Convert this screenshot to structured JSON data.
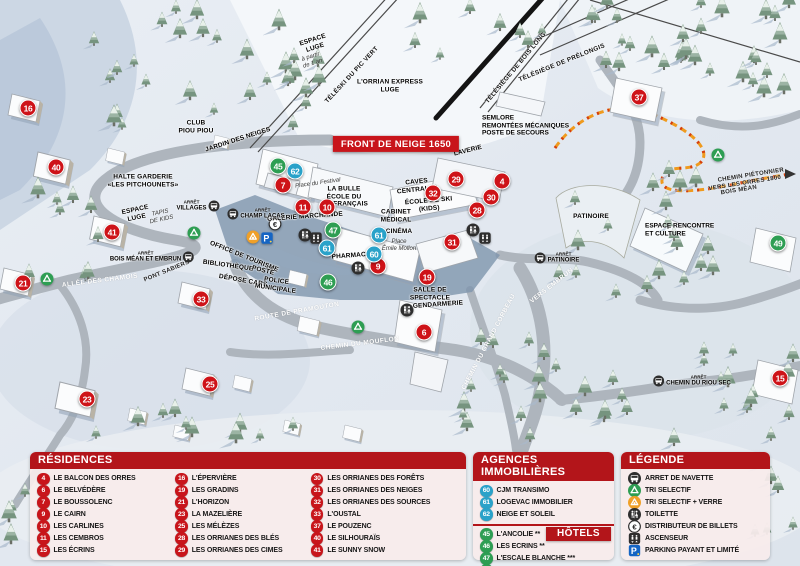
{
  "colors": {
    "accent_red": "#b3151a",
    "residence_red": "#c8151b",
    "agency_blue": "#2aa2c9",
    "hotel_green": "#2e9e53",
    "parking_blue": "#1565c4",
    "trail_orange": "#ef9a1e"
  },
  "map": {
    "bus_prefix": "ARRÊT",
    "banner": "FRONT DE NEIGE 1650",
    "markers": [
      {
        "n": "16",
        "type": "residence",
        "x": 28,
        "y": 108
      },
      {
        "n": "40",
        "type": "residence",
        "x": 56,
        "y": 167
      },
      {
        "n": "41",
        "type": "residence",
        "x": 112,
        "y": 232
      },
      {
        "n": "21",
        "type": "residence",
        "x": 23,
        "y": 283
      },
      {
        "n": "23",
        "type": "residence",
        "x": 87,
        "y": 399
      },
      {
        "n": "25",
        "type": "residence",
        "x": 210,
        "y": 384
      },
      {
        "n": "33",
        "type": "residence",
        "x": 201,
        "y": 299
      },
      {
        "n": "7",
        "type": "residence",
        "x": 283,
        "y": 185
      },
      {
        "n": "11",
        "type": "residence",
        "x": 303,
        "y": 207
      },
      {
        "n": "10",
        "type": "residence",
        "x": 327,
        "y": 207
      },
      {
        "n": "9",
        "type": "residence",
        "x": 378,
        "y": 266
      },
      {
        "n": "19",
        "type": "residence",
        "x": 427,
        "y": 277
      },
      {
        "n": "6",
        "type": "residence",
        "x": 424,
        "y": 332
      },
      {
        "n": "29",
        "type": "residence",
        "x": 456,
        "y": 179
      },
      {
        "n": "32",
        "type": "residence",
        "x": 433,
        "y": 193
      },
      {
        "n": "31",
        "type": "residence",
        "x": 452,
        "y": 242
      },
      {
        "n": "30",
        "type": "residence",
        "x": 491,
        "y": 197
      },
      {
        "n": "28",
        "type": "residence",
        "x": 477,
        "y": 210
      },
      {
        "n": "4",
        "type": "residence",
        "x": 502,
        "y": 181
      },
      {
        "n": "37",
        "type": "residence",
        "x": 639,
        "y": 97
      },
      {
        "n": "15",
        "type": "residence",
        "x": 780,
        "y": 378
      },
      {
        "n": "62",
        "type": "agency",
        "x": 295,
        "y": 171
      },
      {
        "n": "61",
        "type": "agency",
        "x": 327,
        "y": 248
      },
      {
        "n": "61",
        "type": "agency",
        "x": 379,
        "y": 235
      },
      {
        "n": "60",
        "type": "agency",
        "x": 374,
        "y": 254
      },
      {
        "n": "45",
        "type": "hotel",
        "x": 278,
        "y": 166
      },
      {
        "n": "47",
        "type": "hotel",
        "x": 333,
        "y": 230
      },
      {
        "n": "46",
        "type": "hotel",
        "x": 328,
        "y": 282
      },
      {
        "n": "49",
        "type": "hotel",
        "x": 778,
        "y": 243
      }
    ],
    "labels": [
      {
        "t": "CLUB\nPIOU PIOU",
        "x": 196,
        "y": 127,
        "type": "poi"
      },
      {
        "t": "JARDIN DES NEIGES",
        "x": 238,
        "y": 140,
        "type": "poi",
        "rot": -18
      },
      {
        "t": "HALTE GARDERIE\n«LES PITCHOUNETS»",
        "x": 143,
        "y": 181,
        "type": "poi"
      },
      {
        "t": "ESPACE\nLUGE",
        "x": 136,
        "y": 214,
        "type": "poi",
        "rot": -12
      },
      {
        "t": "TAPIS\nDE KIDS",
        "x": 161,
        "y": 217,
        "type": "place",
        "rot": -12
      },
      {
        "t": "PONT SABIERS",
        "x": 167,
        "y": 272,
        "type": "road-dark",
        "rot": -22
      },
      {
        "t": "ALLÉE DES CHAMOIS",
        "x": 100,
        "y": 281,
        "type": "road",
        "rot": -7
      },
      {
        "t": "ESPACE\nLUGE",
        "x": 314,
        "y": 44,
        "type": "poi",
        "rot": -18
      },
      {
        "t": "à partir\nde 1 an",
        "x": 312,
        "y": 61,
        "type": "place",
        "rot": -18
      },
      {
        "t": "TÉLÉSKI DU PIC VERT",
        "x": 352,
        "y": 75,
        "type": "lift",
        "rot": -47
      },
      {
        "t": "L'ORRIAN EXPRESS\nLUGE",
        "x": 390,
        "y": 86,
        "type": "poi"
      },
      {
        "t": "TÉLÉSIÈGE DE BOIS LONG",
        "x": 516,
        "y": 68,
        "type": "lift",
        "rot": -50
      },
      {
        "t": "TÉLÉSIÈGE DE PRÉLONGIS",
        "x": 562,
        "y": 63,
        "type": "lift",
        "rot": -22
      },
      {
        "t": "SEMLORE\nREMONTÉES MÉCANIQUES\nPOSTE DE SECOURS",
        "x": 482,
        "y": 126,
        "type": "poi-left"
      },
      {
        "t": "LAVERIE",
        "x": 468,
        "y": 151,
        "type": "poi",
        "rot": -14
      },
      {
        "t": "CAVES\nCENTRALES",
        "x": 417,
        "y": 186,
        "type": "poi",
        "rot": -6
      },
      {
        "t": "Place du Festival",
        "x": 318,
        "y": 184,
        "type": "place",
        "rot": -8
      },
      {
        "t": "LA BULLE\nÉCOLE DU\nSKI FRANÇAIS",
        "x": 344,
        "y": 197,
        "type": "poi"
      },
      {
        "t": "ÉCOLE DE SKI\n(KIDS)",
        "x": 429,
        "y": 205,
        "type": "poi",
        "rot": -5
      },
      {
        "t": "GALERIE MARCHANDE",
        "x": 305,
        "y": 217,
        "type": "poi",
        "rot": -4
      },
      {
        "t": "CABINET\nMÉDICAL",
        "x": 396,
        "y": 216,
        "type": "poi"
      },
      {
        "t": "CINÉMA",
        "x": 399,
        "y": 232,
        "type": "poi"
      },
      {
        "t": "Place\nÉmile Mollon",
        "x": 399,
        "y": 246,
        "type": "place"
      },
      {
        "t": "PHARMACIE",
        "x": 352,
        "y": 256,
        "type": "poi",
        "rot": -4
      },
      {
        "t": "OFFICE DE TOURISME",
        "x": 244,
        "y": 257,
        "type": "poi",
        "rot": 22
      },
      {
        "t": "BIBLIOTHÈQUE",
        "x": 228,
        "y": 266,
        "type": "poi",
        "rot": 8
      },
      {
        "t": "POSTE",
        "x": 263,
        "y": 271,
        "type": "poi",
        "rot": 14
      },
      {
        "t": "DÉPOSE CARS",
        "x": 243,
        "y": 281,
        "type": "poi",
        "rot": 10
      },
      {
        "t": "POLICE\nMUNICIPALE",
        "x": 276,
        "y": 285,
        "type": "poi",
        "rot": 8
      },
      {
        "t": "SALLE DE\nSPECTACLE",
        "x": 430,
        "y": 294,
        "type": "poi"
      },
      {
        "t": "GENDARMERIE",
        "x": 438,
        "y": 305,
        "type": "poi",
        "rot": -4
      },
      {
        "t": "ROUTE DE PRAMOUTON",
        "x": 297,
        "y": 312,
        "type": "road",
        "rot": -10
      },
      {
        "t": "CHEMIN DU MOUFLON",
        "x": 360,
        "y": 344,
        "type": "road",
        "rot": -7
      },
      {
        "t": "CHEMIN DU GRAND CORBEAU",
        "x": 489,
        "y": 342,
        "type": "road",
        "rot": -62
      },
      {
        "t": "PATINOIRE",
        "x": 591,
        "y": 217,
        "type": "poi"
      },
      {
        "t": "VERS EMBRUN",
        "x": 552,
        "y": 286,
        "type": "road",
        "rot": -38
      },
      {
        "t": "ESPACE RENCONTRE\nET CULTURE",
        "x": 645,
        "y": 230,
        "type": "poi-left"
      },
      {
        "t": "CHEMIN PIÉTONNIER",
        "x": 751,
        "y": 176,
        "type": "road-dark",
        "rot": -9
      },
      {
        "t": "VERS LES ORRES 1800",
        "x": 745,
        "y": 184,
        "type": "road-dark",
        "rot": -9
      },
      {
        "t": "BOIS MÉAN",
        "x": 739,
        "y": 191,
        "type": "road-dark",
        "rot": -9
      },
      {
        "t": "FRONT DE NEIGE 1650",
        "x": 396,
        "y": 144,
        "type": "banner"
      }
    ],
    "bus_stops": [
      {
        "name": "VILLAGES",
        "x": 198,
        "y": 206,
        "side": "right"
      },
      {
        "name": "CHAMP LACAS",
        "x": 256,
        "y": 214,
        "side": "left"
      },
      {
        "name": "BOIS MÉAN ET EMBRUN",
        "x": 152,
        "y": 257,
        "side": "right"
      },
      {
        "name": "PATINOIRE",
        "x": 557,
        "y": 258,
        "side": "left"
      },
      {
        "name": "CHEMIN DU RIOU SEC",
        "x": 692,
        "y": 381,
        "side": "left"
      }
    ],
    "icons": [
      {
        "icon": "recycle-icon",
        "x": 47,
        "y": 279
      },
      {
        "icon": "recycle-icon",
        "x": 194,
        "y": 233
      },
      {
        "icon": "recycle-icon",
        "x": 358,
        "y": 327
      },
      {
        "icon": "recycle-icon",
        "x": 718,
        "y": 155
      },
      {
        "icon": "recycle-glass-icon",
        "x": 253,
        "y": 237
      },
      {
        "icon": "parking-icon",
        "x": 267,
        "y": 238
      },
      {
        "icon": "euro-icon",
        "x": 275,
        "y": 224
      },
      {
        "icon": "toilet-icon",
        "x": 305,
        "y": 235
      },
      {
        "icon": "elevator-icon",
        "x": 316,
        "y": 238
      },
      {
        "icon": "toilet-icon",
        "x": 473,
        "y": 230
      },
      {
        "icon": "elevator-icon",
        "x": 485,
        "y": 238
      },
      {
        "icon": "toilet-icon",
        "x": 358,
        "y": 268
      },
      {
        "icon": "toilet-icon",
        "x": 407,
        "y": 310
      }
    ]
  },
  "panels": {
    "residences": {
      "title": "RÉSIDENCES",
      "items": [
        {
          "n": "4",
          "label": "LE BALCON DES ORRES"
        },
        {
          "n": "6",
          "label": "LE BELVÉDÈRE"
        },
        {
          "n": "7",
          "label": "LE BOUSSOLENC"
        },
        {
          "n": "9",
          "label": "LE CAIRN"
        },
        {
          "n": "10",
          "label": "LES CARLINES"
        },
        {
          "n": "11",
          "label": "LES CEMBROS"
        },
        {
          "n": "15",
          "label": "LES ÉCRINS"
        },
        {
          "n": "16",
          "label": "L'ÉPERVIÈRE"
        },
        {
          "n": "19",
          "label": "LES GRADINS"
        },
        {
          "n": "21",
          "label": "L'HORIZON"
        },
        {
          "n": "23",
          "label": "LA MAZELIÈRE"
        },
        {
          "n": "25",
          "label": "LES MÉLÈZES"
        },
        {
          "n": "28",
          "label": "LES ORRIANES DES BLÉS"
        },
        {
          "n": "29",
          "label": "LES ORRIANES DES CIMES"
        },
        {
          "n": "30",
          "label": "LES ORRIANES DES FORÊTS"
        },
        {
          "n": "31",
          "label": "LES ORRIANES DES NEIGES"
        },
        {
          "n": "32",
          "label": "LES ORRIANES DES SOURCES"
        },
        {
          "n": "33",
          "label": "L'OUSTAL"
        },
        {
          "n": "37",
          "label": "LE POUZENC"
        },
        {
          "n": "40",
          "label": "LE SILHOURAÏS"
        },
        {
          "n": "41",
          "label": "LE SUNNY SNOW"
        }
      ]
    },
    "agencies": {
      "title": "AGENCES IMMOBILIÈRES",
      "items": [
        {
          "n": "60",
          "label": "CJM TRANSIMO"
        },
        {
          "n": "61",
          "label": "LOGEVAC IMMOBILIER"
        },
        {
          "n": "62",
          "label": "NEIGE ET SOLEIL"
        }
      ]
    },
    "hotels": {
      "title": "HÔTELS",
      "items": [
        {
          "n": "45",
          "label": "L'ANCOLIE **"
        },
        {
          "n": "46",
          "label": "LES ECRINS **"
        },
        {
          "n": "47",
          "label": "L'ESCALE BLANCHE ***"
        },
        {
          "n": "49",
          "label": "LES TRAPPEURS **"
        }
      ]
    },
    "legend": {
      "title": "LÉGENDE",
      "items": [
        {
          "icon": "bus-icon",
          "label": "ARRET DE NAVETTE"
        },
        {
          "icon": "recycle-icon",
          "label": "TRI SELECTIF"
        },
        {
          "icon": "recycle-glass-icon",
          "label": "TRI SELECTIF + VERRE"
        },
        {
          "icon": "toilet-icon",
          "label": "TOILETTE"
        },
        {
          "icon": "euro-icon",
          "label": "DISTRIBUTEUR DE BILLETS"
        },
        {
          "icon": "elevator-icon",
          "label": "ASCENSEUR"
        },
        {
          "icon": "parking-icon",
          "label": "PARKING PAYANT ET LIMITÉ"
        }
      ]
    }
  }
}
